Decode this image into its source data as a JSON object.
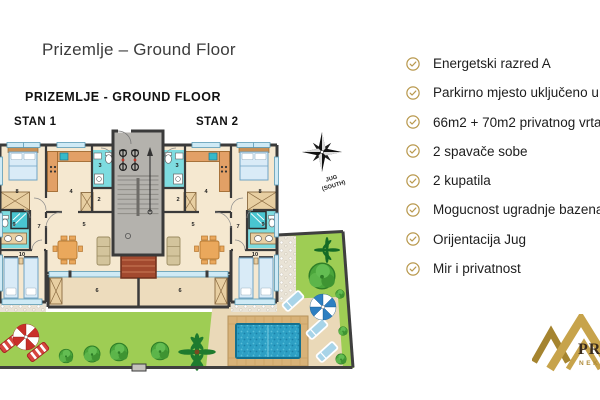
{
  "page": {
    "title": "Prizemlje – Ground Floor",
    "background": "#ffffff"
  },
  "plan": {
    "heading": "PRIZEMLJE - GROUND FLOOR",
    "apartment1_label": "STAN 1",
    "apartment2_label": "STAN 2",
    "compass": {
      "line1": "JUG",
      "line2": "(SOUTH)"
    },
    "room_numbers": [
      {
        "n": "8",
        "x": 17,
        "y": 193
      },
      {
        "n": "4",
        "x": 71,
        "y": 193
      },
      {
        "n": "3",
        "x": 100,
        "y": 167
      },
      {
        "n": "2",
        "x": 99,
        "y": 201
      },
      {
        "n": "5",
        "x": 84,
        "y": 226
      },
      {
        "n": "7",
        "x": 39,
        "y": 228
      },
      {
        "n": "9",
        "x": 14,
        "y": 226
      },
      {
        "n": "10",
        "x": 22,
        "y": 256
      },
      {
        "n": "6",
        "x": 97,
        "y": 292
      },
      {
        "n": "8",
        "x": 260,
        "y": 193
      },
      {
        "n": "4",
        "x": 206,
        "y": 193
      },
      {
        "n": "3",
        "x": 177,
        "y": 167
      },
      {
        "n": "2",
        "x": 178,
        "y": 201
      },
      {
        "n": "5",
        "x": 193,
        "y": 226
      },
      {
        "n": "7",
        "x": 238,
        "y": 228
      },
      {
        "n": "9",
        "x": 263,
        "y": 226
      },
      {
        "n": "10",
        "x": 255,
        "y": 256
      },
      {
        "n": "6",
        "x": 180,
        "y": 292
      }
    ],
    "colors": {
      "wall": "#3a3a3a",
      "floor": "#f5e8d0",
      "terrace": "#eddcbd",
      "wet_room": "#7edce0",
      "lawn": "#9ecd54",
      "pool_water": "#2d9fc4",
      "pool_deck": "#d8b278",
      "stairwell": "#b4b2ad"
    }
  },
  "features": {
    "icon": "check-circle",
    "icon_color": "#b9994e",
    "items": [
      "Energetski razred A",
      "Parkirno mjesto uključeno u c",
      "66m2 + 70m2 privatnog vrta i",
      "2 spavače sobe",
      "2 kupatila",
      "Mogucnost ugradnje bazena",
      "Orijentacija Jug",
      "Mir i privatnost"
    ]
  },
  "logo": {
    "name_fragment": "PRI",
    "subtitle_fragment": "NEK",
    "gold": "#c7a34b",
    "gold_dark": "#a5842f"
  }
}
